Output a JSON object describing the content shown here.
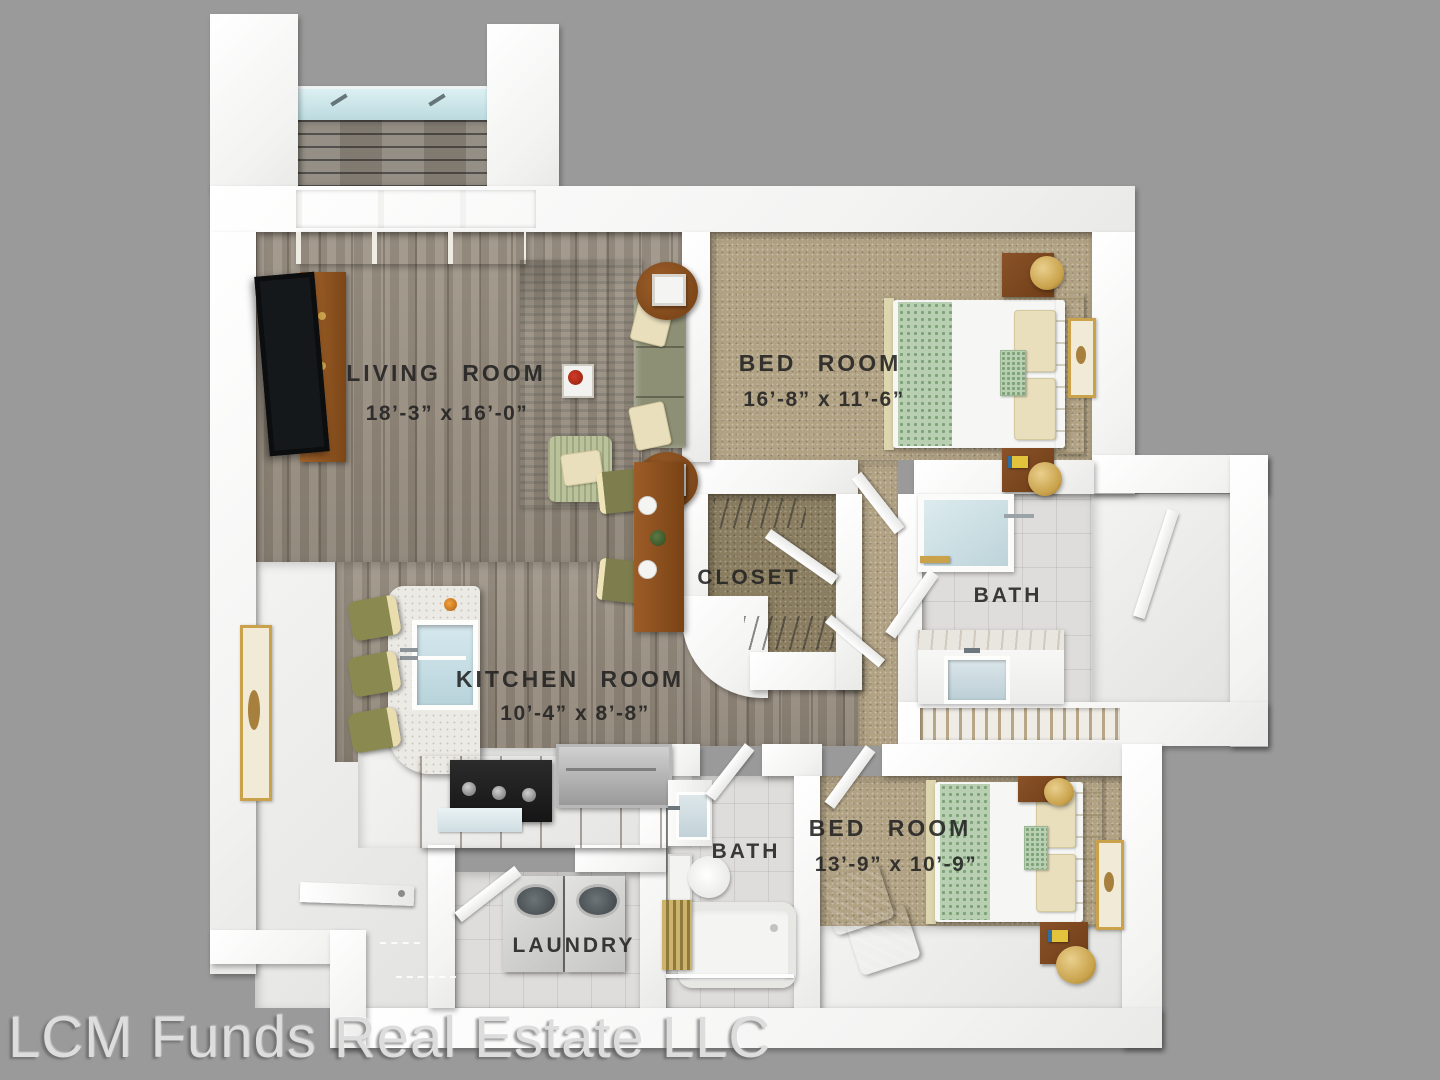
{
  "watermark": "LCM Funds Real Estate LLC",
  "rooms": {
    "living": {
      "name": "LIVING ROOM",
      "dimensions": "18’-3” x 16’-0”"
    },
    "bedroom1": {
      "name": "BED ROOM",
      "dimensions": "16’-8” x 11’-6”"
    },
    "closet": {
      "name": "CLOSET"
    },
    "bath1": {
      "name": "BATH"
    },
    "kitchen": {
      "name": "KITCHEN ROOM",
      "dimensions": "10’-4” x 8’-8”"
    },
    "bath2": {
      "name": "BATH"
    },
    "bedroom2": {
      "name": "BED ROOM",
      "dimensions": "13’-9” x 10’-9”"
    },
    "laundry": {
      "name": "LAUNDRY"
    }
  },
  "colors": {
    "bg": "#9a9a9a",
    "wall": "#fafafa",
    "wood": "#988d7f",
    "carpet": "#b2a284",
    "carpetDark": "#8a7d60",
    "tile": "#dedddb",
    "floorWhite": "#ebebe9",
    "label": "#222222",
    "watermark": "#dddddd",
    "sofa": "#8e9076",
    "furnitureWood": "#8a5228",
    "gold": "#c9a24b",
    "glass": "#c3dde2",
    "bedding": "#f6f6f4",
    "runnerGreen": "#b9cfb2"
  }
}
